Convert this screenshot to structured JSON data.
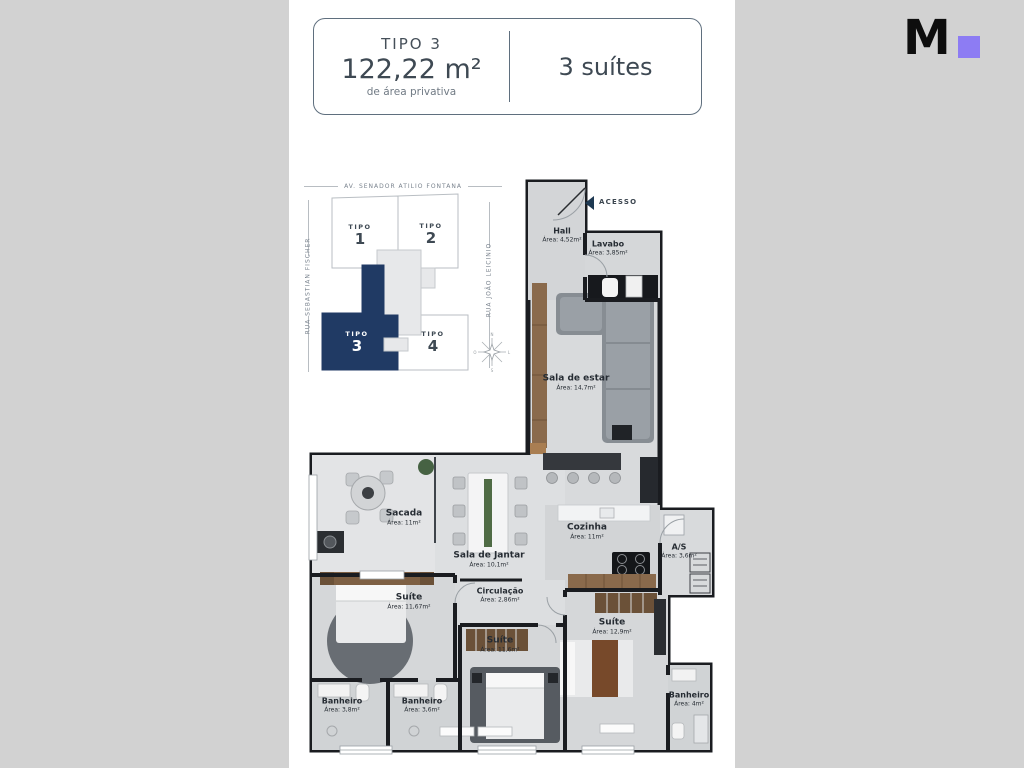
{
  "colors": {
    "background": "#d2d2d2",
    "panel": "#ffffff",
    "accent_purple": "#8d7cf3",
    "navy_highlight": "#203a64",
    "wall": "#1a1c20",
    "header_border": "#5f6f7e"
  },
  "logo": {
    "letter": "M",
    "square_icon": "purple-square"
  },
  "header": {
    "tipo": "TIPO 3",
    "area": "122,22 m²",
    "area_caption": "de área privativa",
    "suites": "3 suítes"
  },
  "siteplan": {
    "street_top": "AV. SENADOR ATILIO FONTANA",
    "street_left": "RUA SEBASTIAN FISCHER",
    "street_right": "RUA JOÃO LEICINIO",
    "units": [
      {
        "type": "TIPO",
        "number": "1",
        "highlighted": false
      },
      {
        "type": "TIPO",
        "number": "2",
        "highlighted": false
      },
      {
        "type": "TIPO",
        "number": "3",
        "highlighted": true
      },
      {
        "type": "TIPO",
        "number": "4",
        "highlighted": false
      }
    ],
    "compass_icon": "compass-rose",
    "compass_points": {
      "n": "N",
      "e": "L",
      "s": "S",
      "w": "O"
    }
  },
  "floorplan": {
    "access_label": "ACESSO",
    "access_icon": "left-triangle-arrow",
    "rooms": [
      {
        "name": "Hall",
        "area": "Área: 4,52m²"
      },
      {
        "name": "Lavabo",
        "area": "Área: 3,85m²"
      },
      {
        "name": "Sala de estar",
        "area": "Área: 14,7m²"
      },
      {
        "name": "Sacada",
        "area": "Área: 11m²"
      },
      {
        "name": "Sala de Jantar",
        "area": "Área: 10,1m²"
      },
      {
        "name": "Cozinha",
        "area": "Área: 11m²"
      },
      {
        "name": "A/S",
        "area": "Área: 3,6m²"
      },
      {
        "name": "Circulação",
        "area": "Área: 2,86m²"
      },
      {
        "name": "Suíte",
        "area": "Área: 11,67m²"
      },
      {
        "name": "Suíte",
        "area": "Área: 11,6m²"
      },
      {
        "name": "Suíte",
        "area": "Área: 12,9m²"
      },
      {
        "name": "Banheiro",
        "area": "Área: 3,8m²"
      },
      {
        "name": "Banheiro",
        "area": "Área: 3,6m²"
      },
      {
        "name": "Banheiro",
        "area": "Área: 4m²"
      }
    ]
  }
}
